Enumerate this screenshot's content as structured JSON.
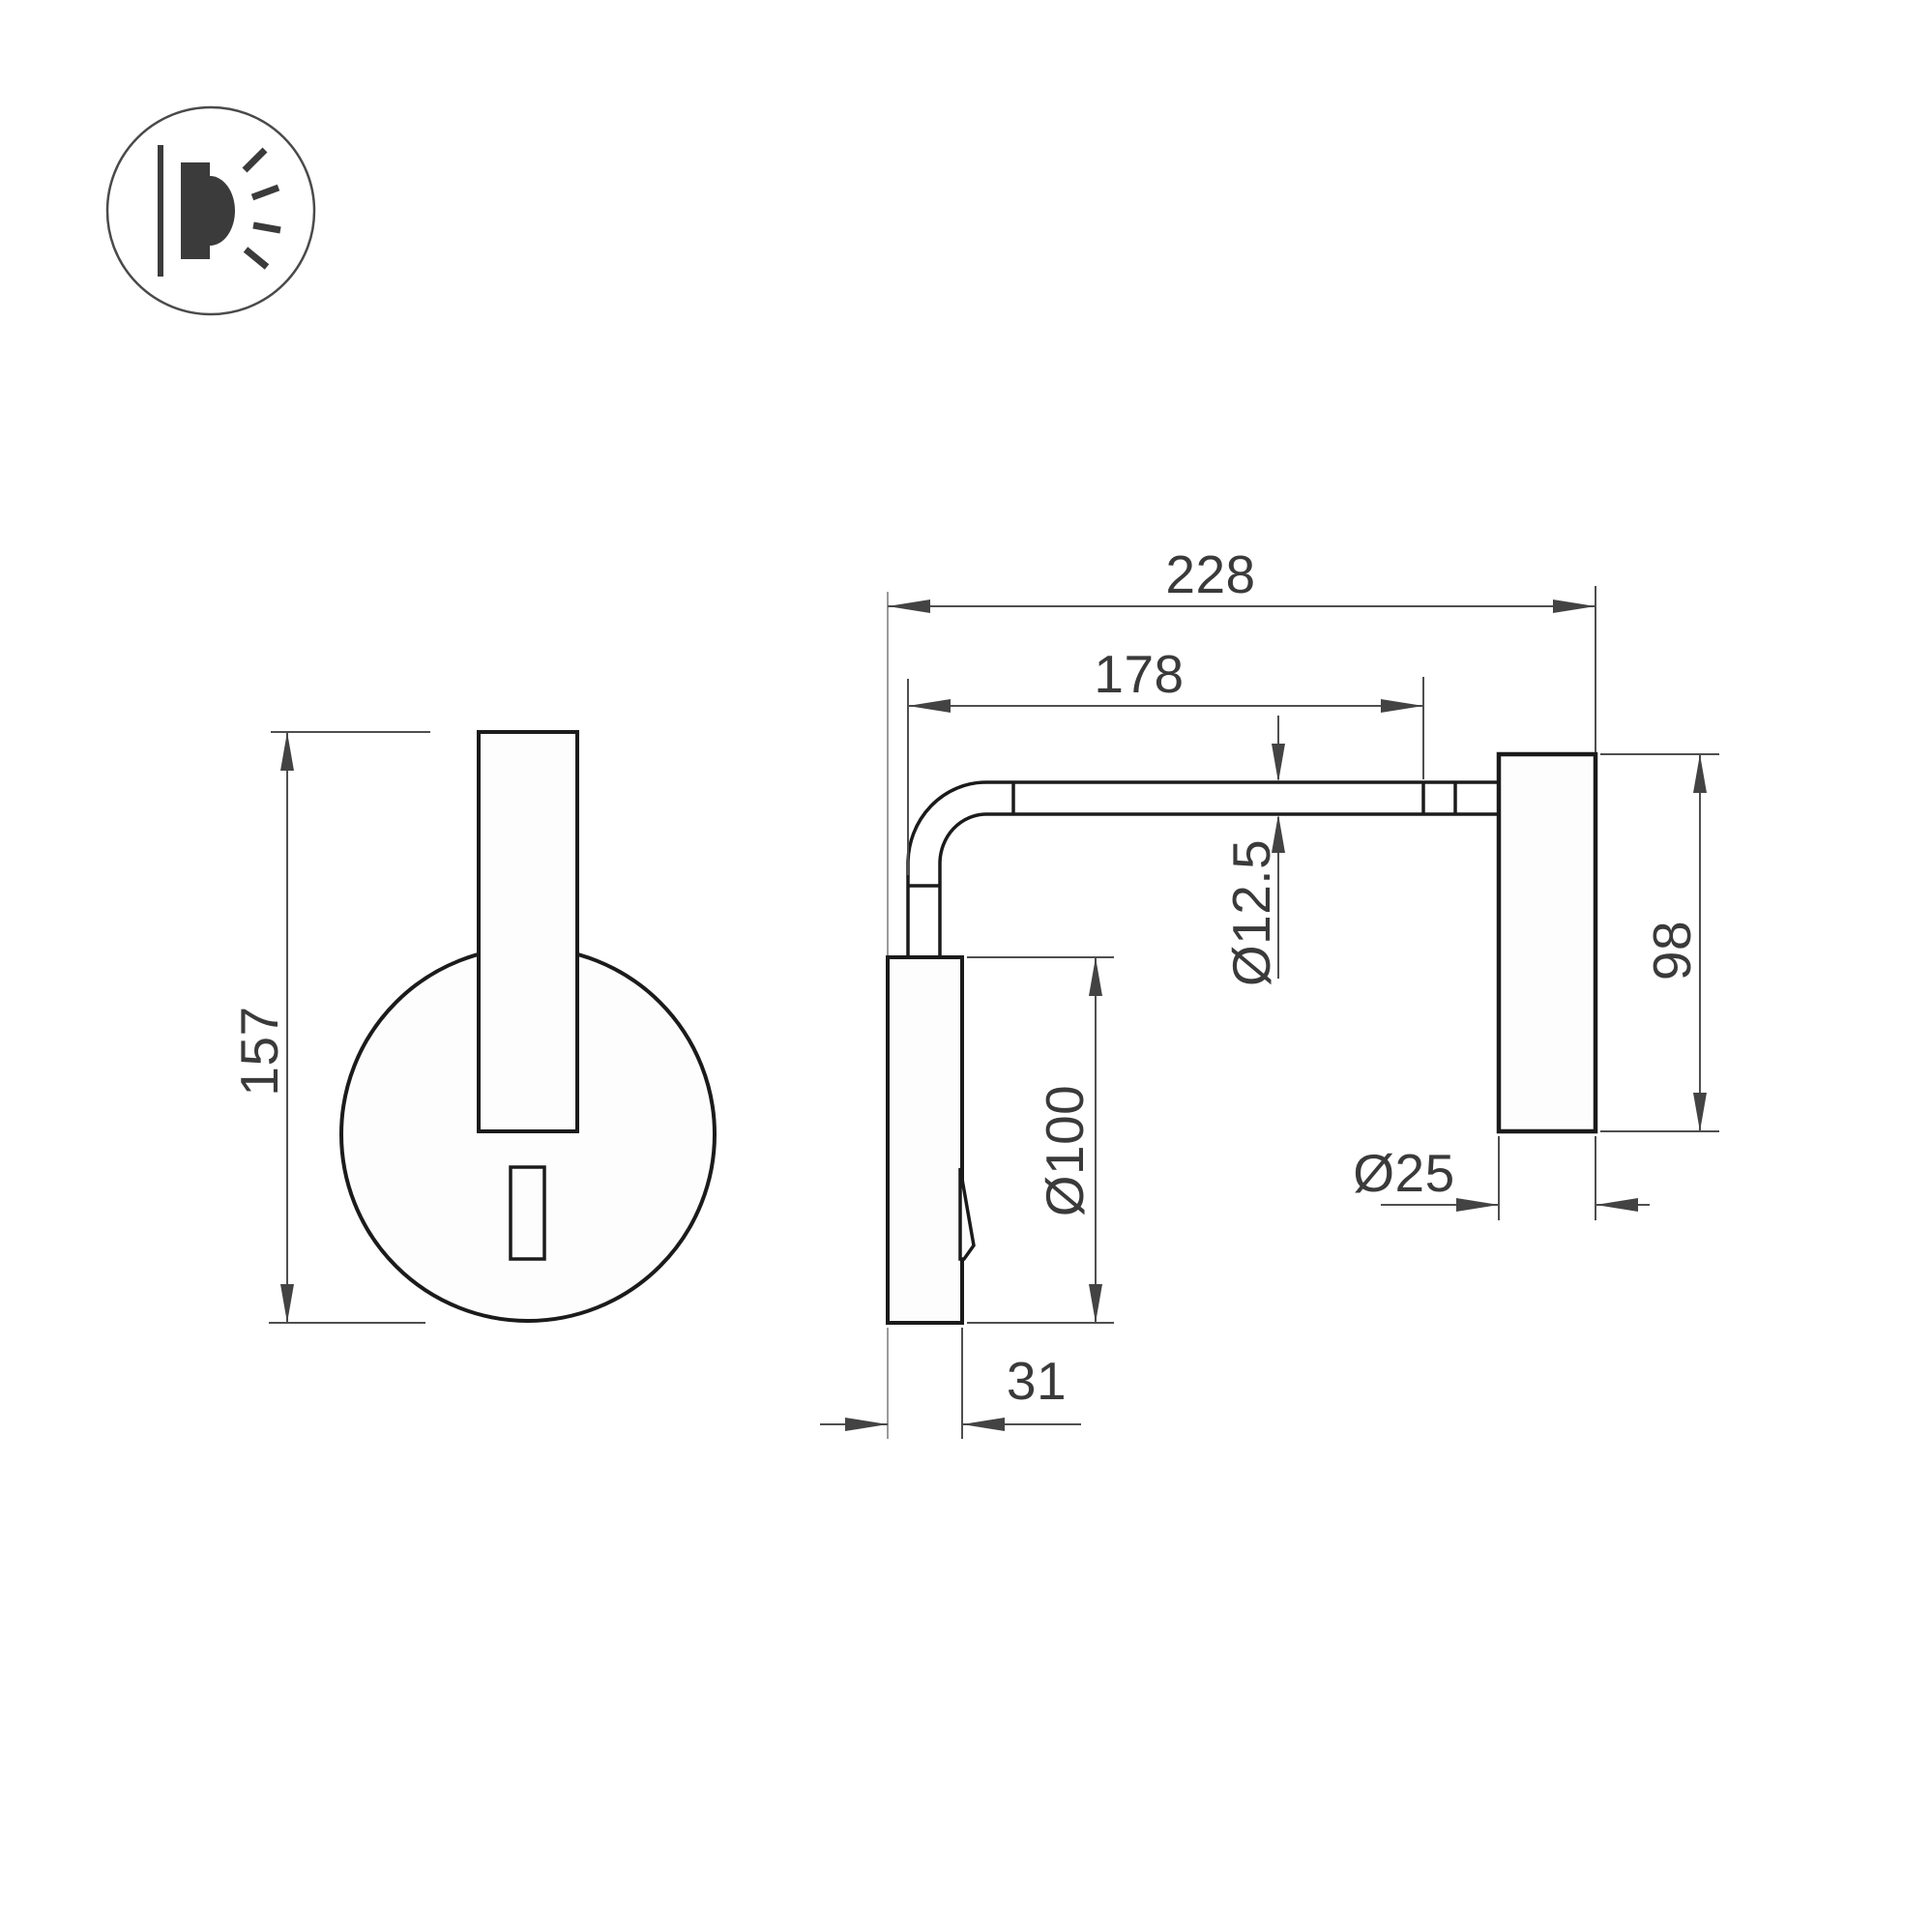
{
  "page": {
    "background_color": "#ffffff",
    "line_color": "#1b1b1b",
    "dimension_line_color": "#4f4f4f",
    "dimension_text_color": "#3a3a3a",
    "icon_color": "#3b3b3b"
  },
  "logo": {
    "icon": "wall-lamp-light-icon",
    "description": "circle badge with wall-mounted lamp emitting light rays"
  },
  "drawing": {
    "type": "technical-dimension-drawing",
    "views": {
      "front_view": {
        "parts": [
          "round-wall-plate",
          "vertical-lamp-tube",
          "toggle-switch"
        ],
        "dimensions": {
          "overall_height": "157"
        }
      },
      "side_view": {
        "parts": [
          "wall-plate",
          "bent-arm-tube",
          "cylindrical-lamp-head",
          "toggle-switch"
        ],
        "dimensions": {
          "overall_depth": "228",
          "arm_length": "178",
          "arm_tube_diameter": "Ø12.5",
          "plate_diameter": "Ø100",
          "head_height": "98",
          "head_diameter": "Ø25",
          "plate_depth": "31"
        }
      }
    }
  }
}
